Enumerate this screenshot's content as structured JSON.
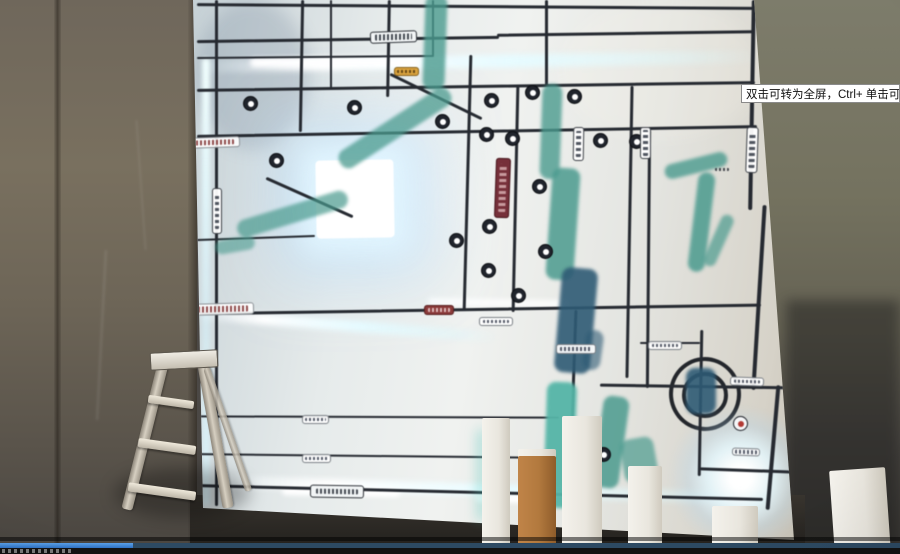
{
  "video_player": {
    "tooltip_text": "双击可转为全屏，Ctrl+ 单击可转为",
    "progress_percent": 15,
    "progress_played_color": "#3f7fd2",
    "progress_remaining_color": "#2d4a63"
  },
  "scene": {
    "objects_visible": [
      "illuminated map board",
      "step ladder",
      "white foam columns",
      "concrete wall"
    ],
    "map_glow_color": "#eafcff",
    "river_color": "#4a9a8e",
    "road_color": "#262a31",
    "highlight_lot_color": "#ffffff"
  }
}
